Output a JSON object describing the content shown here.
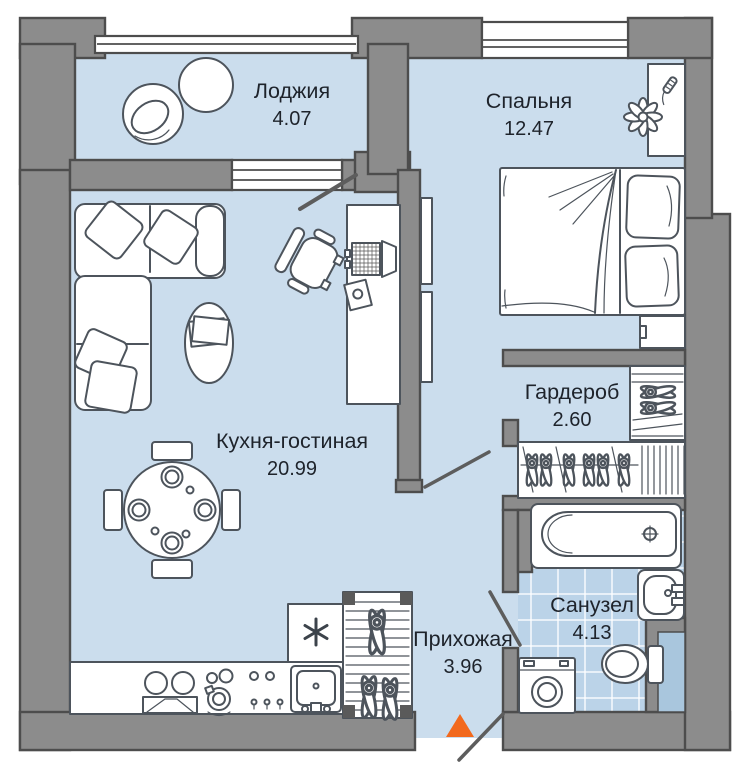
{
  "rooms": [
    {
      "id": "loggia",
      "name": "Лоджия",
      "area": "4.07"
    },
    {
      "id": "bedroom",
      "name": "Спальня",
      "area": "12.47"
    },
    {
      "id": "kitchen_living",
      "name": "Кухня-гостиная",
      "area": "20.99"
    },
    {
      "id": "wardrobe",
      "name": "Гардероб",
      "area": "2.60"
    },
    {
      "id": "hallway",
      "name": "Прихожая",
      "area": "3.96"
    },
    {
      "id": "bathroom",
      "name": "Санузел",
      "area": "4.13"
    }
  ],
  "colors": {
    "room_fill": "#cbdded",
    "tile_fill": "#bbd3e8",
    "shaft_fill": "#a9c6dd",
    "wall_fill": "#8c8c8c",
    "wall_stroke": "#4d4d4d",
    "furniture_stroke": "#4d545c",
    "label_text": "#1e232b",
    "entrance_marker": "#f2691d"
  },
  "icons": {
    "entrance_marker": "triangle-up",
    "fridge_badge": "snowflake-asterisk"
  }
}
